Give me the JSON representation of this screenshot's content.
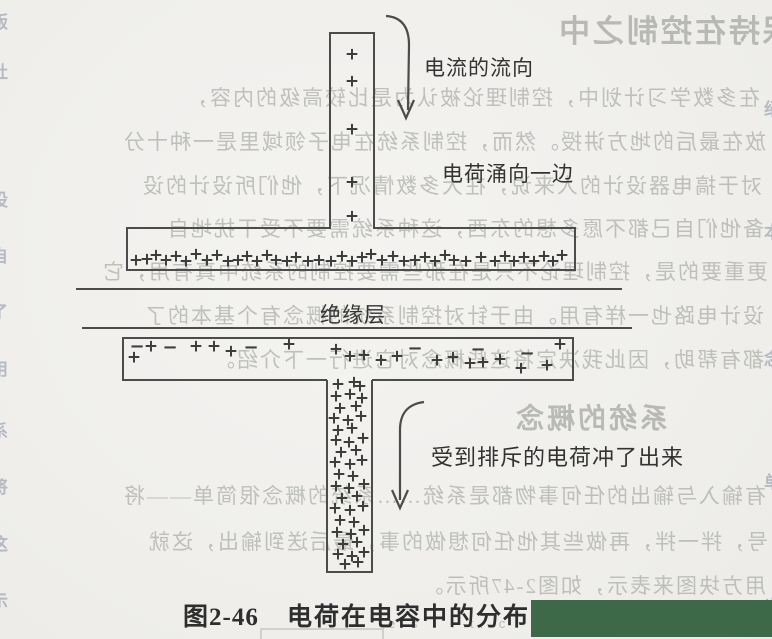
{
  "figure": {
    "caption_prefix": "图2-46",
    "caption_title": "电荷在电容中的分布",
    "labels": {
      "current_flow": "电流的流向",
      "charge_surge": "电荷涌向一边",
      "insulation": "绝缘层",
      "repelled": "受到排斥的电荷冲了出来"
    }
  },
  "watermark_text": "e s l i t. c",
  "colors": {
    "ink": "#4c4c4c",
    "charge_ink": "#3d3d3d",
    "paper": "#f1f0ed",
    "ghost_text": "#b2b5b0",
    "edge_mark": "#6e7b92",
    "censor_green": "#3e6949"
  },
  "charges": {
    "top_bar": [
      [
        352,
        55
      ],
      [
        352,
        82
      ],
      [
        352,
        130
      ],
      [
        352,
        183
      ],
      [
        352,
        217
      ]
    ],
    "top_plate": [
      [
        136,
        261
      ],
      [
        147,
        260
      ],
      [
        156,
        256
      ],
      [
        166,
        261
      ],
      [
        176,
        257
      ],
      [
        186,
        262
      ],
      [
        196,
        255
      ],
      [
        207,
        261
      ],
      [
        217,
        256
      ],
      [
        228,
        262
      ],
      [
        238,
        261
      ],
      [
        247,
        257
      ],
      [
        257,
        262
      ],
      [
        267,
        256
      ],
      [
        276,
        261
      ],
      [
        287,
        262
      ],
      [
        296,
        258
      ],
      [
        308,
        262
      ],
      [
        319,
        261
      ],
      [
        331,
        262
      ],
      [
        342,
        257
      ],
      [
        352,
        262
      ],
      [
        362,
        258
      ],
      [
        371,
        255
      ],
      [
        382,
        261
      ],
      [
        393,
        257
      ],
      [
        404,
        262
      ],
      [
        415,
        261
      ],
      [
        425,
        258
      ],
      [
        435,
        262
      ],
      [
        445,
        256
      ],
      [
        454,
        261
      ],
      [
        466,
        262
      ],
      [
        481,
        258
      ],
      [
        495,
        262
      ],
      [
        505,
        257
      ],
      [
        514,
        262
      ],
      [
        524,
        258
      ],
      [
        534,
        262
      ],
      [
        544,
        257
      ],
      [
        553,
        262
      ],
      [
        562,
        256
      ]
    ],
    "lower_plate": [
      [
        137,
        347,
        "-"
      ],
      [
        151,
        347,
        "+"
      ],
      [
        170,
        348,
        "-"
      ],
      [
        196,
        347,
        "+"
      ],
      [
        214,
        347,
        "+"
      ],
      [
        231,
        352,
        "+"
      ],
      [
        251,
        348,
        "-"
      ],
      [
        289,
        345,
        "+"
      ],
      [
        134,
        358,
        "+"
      ],
      [
        336,
        350,
        "+"
      ],
      [
        350,
        357,
        "+"
      ],
      [
        364,
        356,
        "+"
      ],
      [
        381,
        361,
        "+"
      ],
      [
        397,
        357,
        "+"
      ],
      [
        415,
        349,
        "-"
      ],
      [
        437,
        361,
        "+"
      ],
      [
        453,
        358,
        "+"
      ],
      [
        470,
        364,
        "+"
      ],
      [
        483,
        363,
        "+"
      ],
      [
        500,
        360,
        "+"
      ],
      [
        478,
        350,
        "-"
      ],
      [
        521,
        369,
        "+"
      ],
      [
        527,
        354,
        "-"
      ],
      [
        547,
        366,
        "+"
      ],
      [
        560,
        345,
        "+"
      ]
    ],
    "bottom_bar": [
      [
        338,
        385
      ],
      [
        354,
        383
      ],
      [
        360,
        387
      ],
      [
        336,
        397
      ],
      [
        350,
        395
      ],
      [
        362,
        399
      ],
      [
        340,
        409
      ],
      [
        356,
        407
      ],
      [
        334,
        419
      ],
      [
        348,
        421
      ],
      [
        361,
        417
      ],
      [
        338,
        431
      ],
      [
        352,
        429
      ],
      [
        336,
        441
      ],
      [
        349,
        443
      ],
      [
        363,
        439
      ],
      [
        341,
        453
      ],
      [
        356,
        451
      ],
      [
        335,
        463
      ],
      [
        350,
        465
      ],
      [
        362,
        461
      ],
      [
        339,
        475
      ],
      [
        353,
        477
      ],
      [
        336,
        487
      ],
      [
        349,
        489
      ],
      [
        364,
        485
      ],
      [
        342,
        499
      ],
      [
        357,
        497
      ],
      [
        335,
        509
      ],
      [
        350,
        511
      ],
      [
        363,
        507
      ],
      [
        340,
        521
      ],
      [
        354,
        523
      ],
      [
        337,
        533
      ],
      [
        351,
        535
      ],
      [
        364,
        531
      ],
      [
        343,
        545
      ],
      [
        357,
        543
      ],
      [
        338,
        555
      ],
      [
        352,
        557
      ],
      [
        364,
        553
      ],
      [
        345,
        565
      ],
      [
        358,
        563
      ]
    ]
  },
  "ghost": {
    "lines": [
      {
        "top": 6,
        "left": -22,
        "size": 31,
        "heading": true,
        "text": "保持在控制之中"
      },
      {
        "top": 82,
        "left": 12,
        "size": 21,
        "heading": false,
        "text": "在多数学习计划中，控制理论被认为是比较高级的内容，"
      },
      {
        "top": 126,
        "left": 6,
        "size": 21,
        "heading": false,
        "text": "放在最后的地方讲授。然而，控制系统在电子领域里是一种十分"
      },
      {
        "top": 170,
        "left": 10,
        "size": 21,
        "heading": false,
        "text": "对于搞电器设计的人来说，在大多数情况下，他们所设计的设"
      },
      {
        "top": 213,
        "left": 8,
        "size": 21,
        "heading": false,
        "text": "备他们自己都不愿多想的东西，这种系统需要不受干扰地自"
      },
      {
        "top": 256,
        "left": 4,
        "size": 21,
        "heading": false,
        "text": "更重要的是，控制理论不只是在那些需要控制的系统中真有用，它"
      },
      {
        "top": 300,
        "left": 8,
        "size": 21,
        "heading": false,
        "text": "设计电路也一样有用。由于针对控制系统的概念有个基本的了"
      },
      {
        "top": 344,
        "left": 8,
        "size": 21,
        "heading": false,
        "text": "都有帮助，因此我决定将这些概念对它进行一下介绍。"
      },
      {
        "top": 397,
        "left": 104,
        "size": 28,
        "heading": true,
        "text": "系统的概念"
      },
      {
        "top": 480,
        "left": 6,
        "size": 21,
        "heading": false,
        "text": "有输入与输出的任何事物都是系统……系统的概念很简单——将"
      },
      {
        "top": 526,
        "left": 4,
        "size": 21,
        "heading": false,
        "text": "号，拌一拌，再做些其他任何想做的事，最后送到输出，这就"
      },
      {
        "top": 570,
        "left": 6,
        "size": 21,
        "heading": false,
        "text": "用方块图来表示，如图2-47所示。"
      }
    ],
    "box": {
      "left": 260,
      "top": 628,
      "width": 120,
      "height": 11
    }
  },
  "edge_marks": {
    "left": [
      [
        8,
        "版"
      ],
      [
        58,
        "社"
      ],
      [
        186,
        "设"
      ],
      [
        242,
        "自"
      ],
      [
        298,
        "了"
      ],
      [
        355,
        "用"
      ],
      [
        417,
        "系"
      ],
      [
        473,
        "将"
      ],
      [
        530,
        "这"
      ],
      [
        587,
        "示"
      ]
    ],
    "right": [
      [
        95,
        "绍"
      ],
      [
        218,
        "本"
      ],
      [
        345,
        "念"
      ],
      [
        468,
        "单"
      ],
      [
        592,
        "出"
      ]
    ]
  }
}
